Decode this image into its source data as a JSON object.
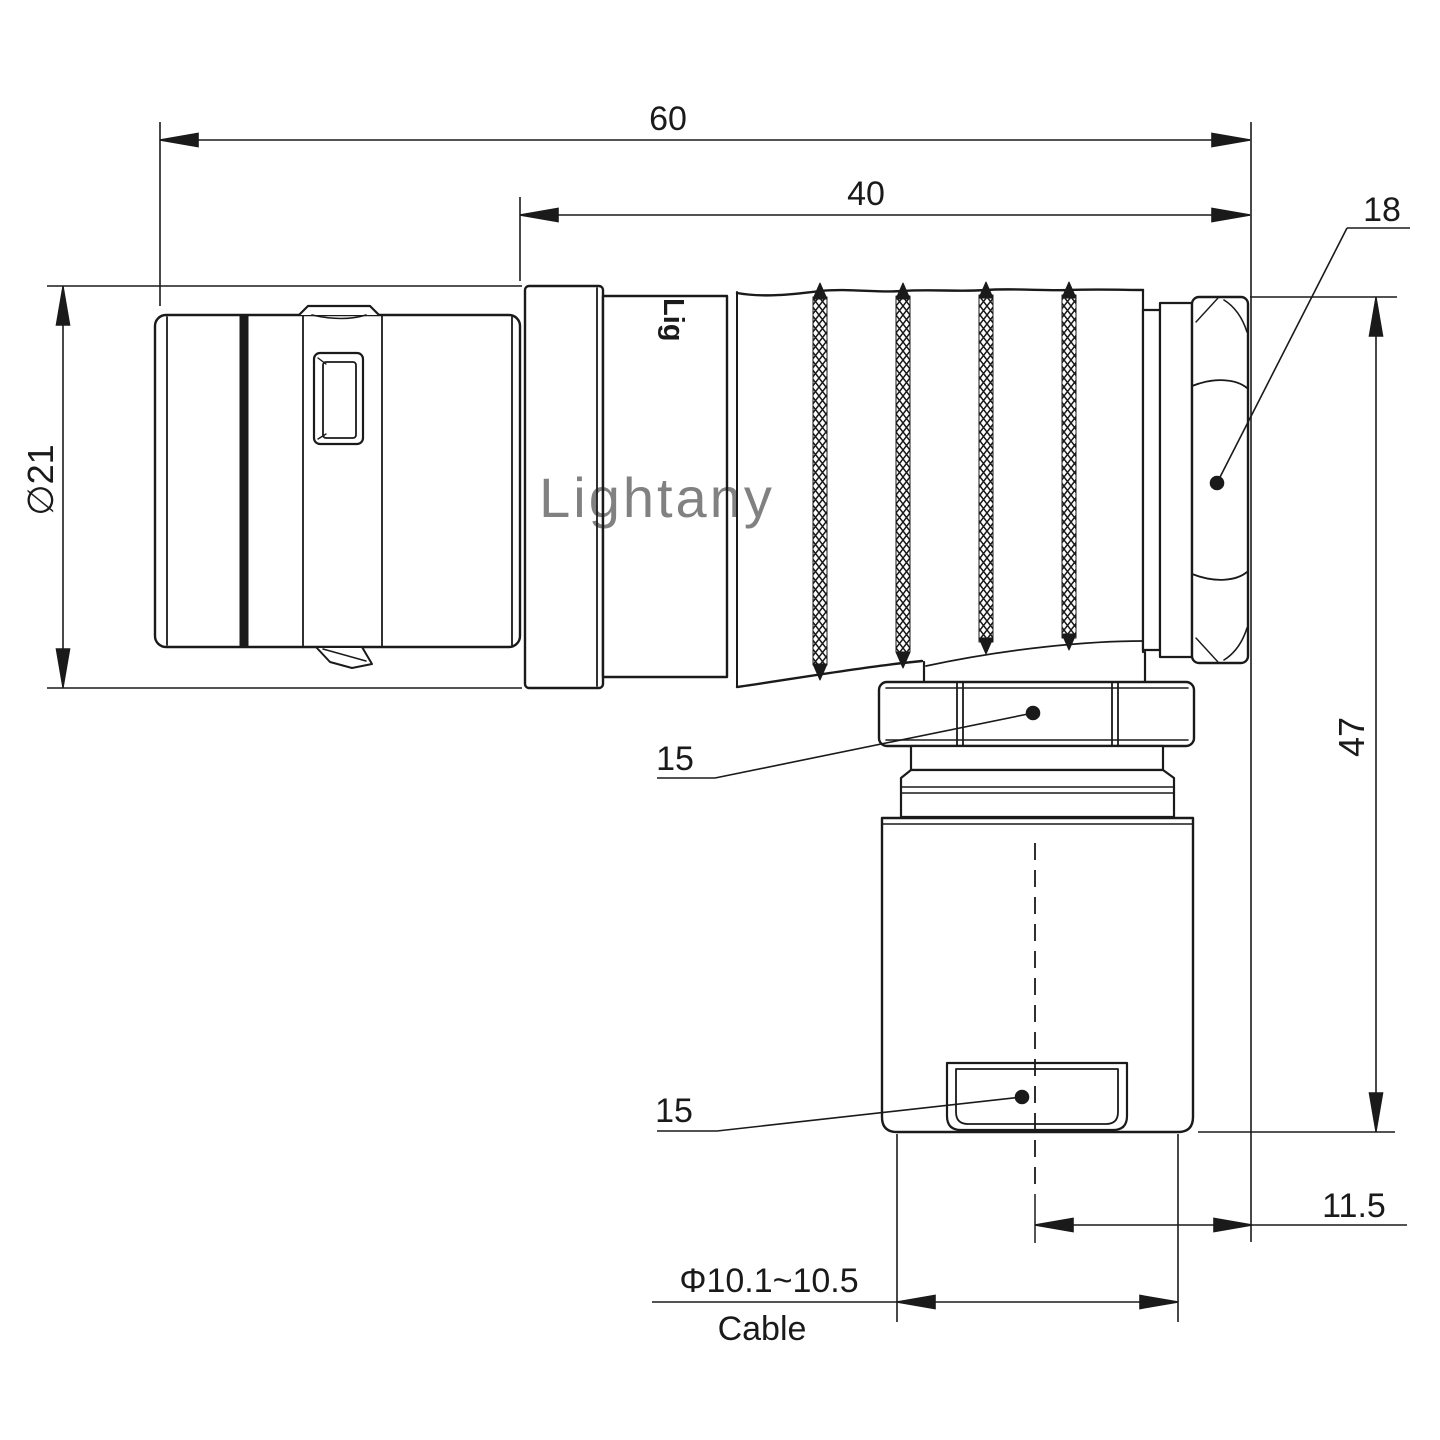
{
  "drawing": {
    "watermark_text": "Lightany",
    "part_logo_text": "Lig",
    "dims": {
      "overall_length": "60",
      "rear_length": "40",
      "backnut_dia": "18",
      "front_dia": "∅21",
      "height": "47",
      "elbow_nut": "15",
      "clamp": "15",
      "cable_offset": "11.5",
      "cable_dia": "Φ10.1~10.5",
      "cable_word": "Cable"
    },
    "colors": {
      "line": "#1a1a1a",
      "watermark": "#f2b4b4",
      "background": "#ffffff"
    }
  }
}
